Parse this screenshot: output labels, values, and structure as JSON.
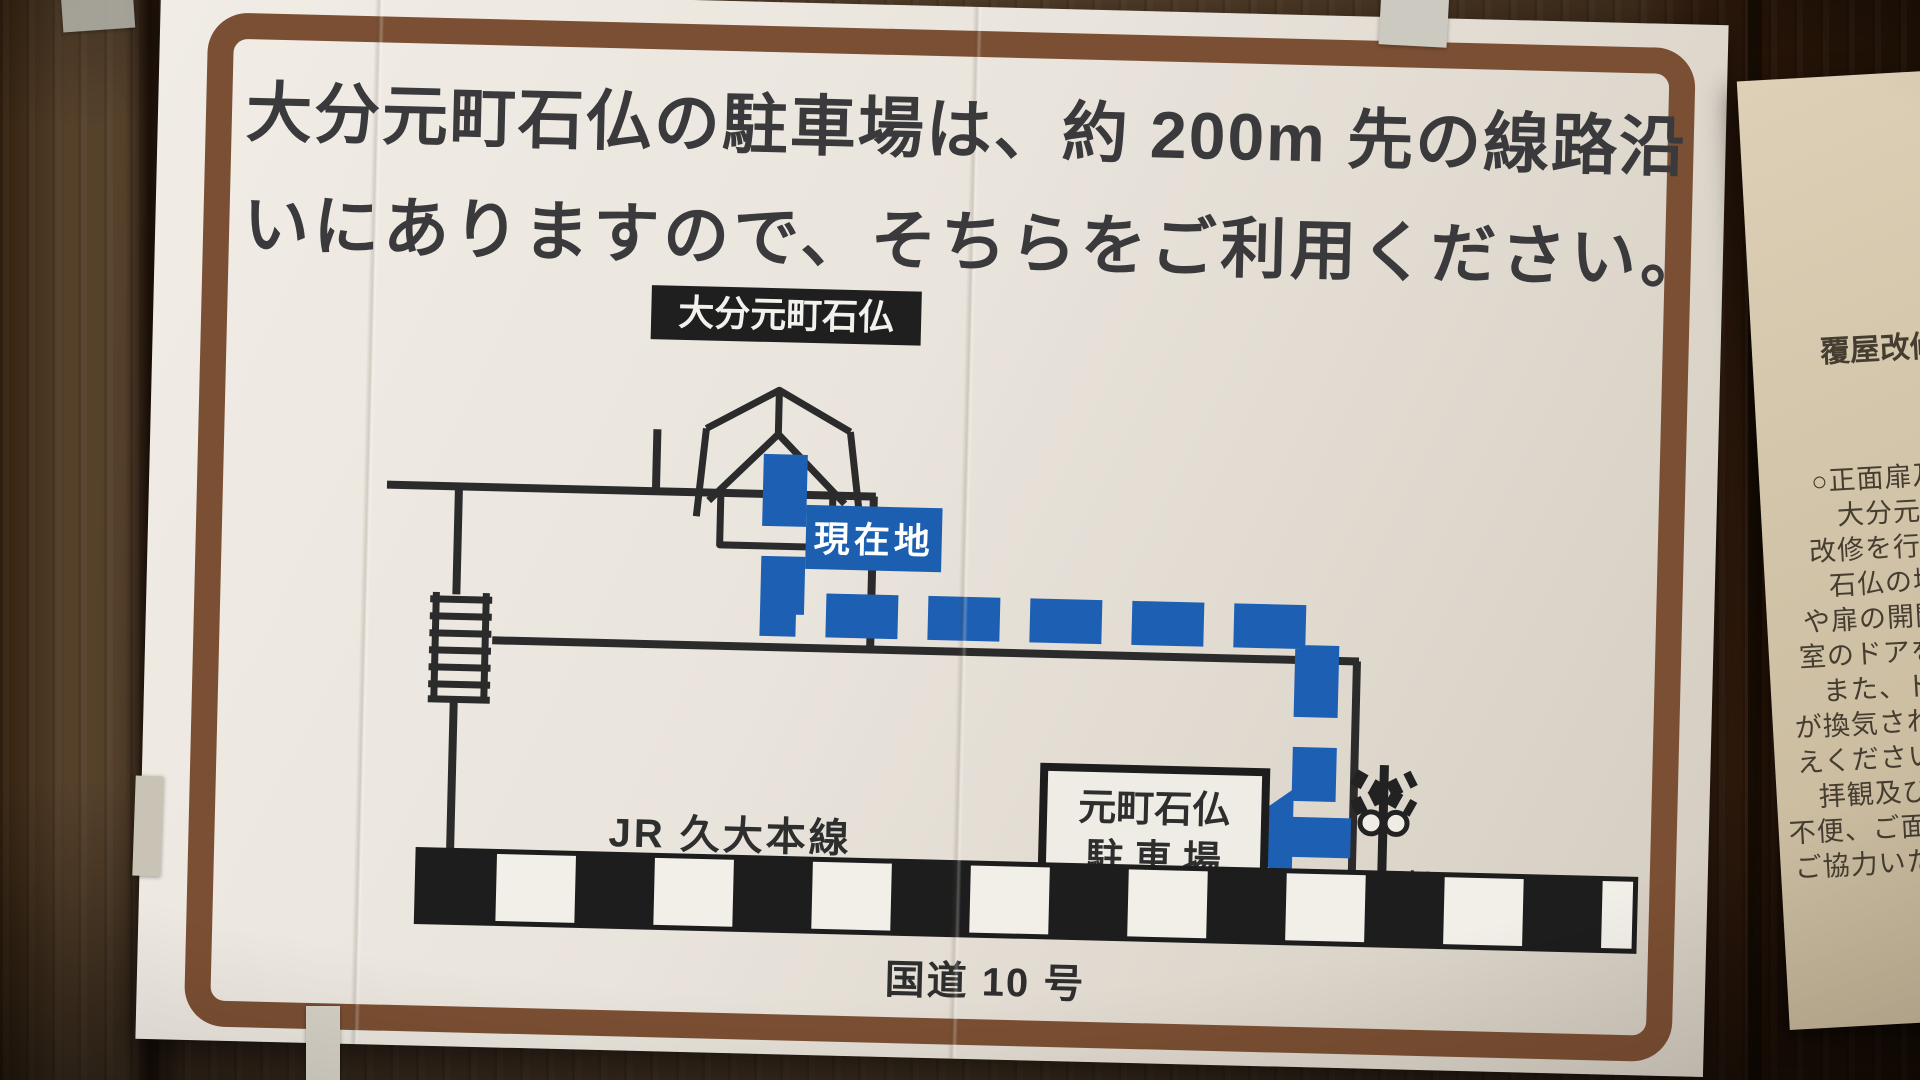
{
  "poster": {
    "heading_line1": "大分元町石仏の駐車場は、約 200m 先の線路沿",
    "heading_line2": "いにありますので、そちらをご利用ください。",
    "map": {
      "site_label": "大分元町石仏",
      "current_location_label": "現在地",
      "parking_label_line1": "元町石仏",
      "parking_label_line2": "駐 車 場",
      "railway_label": "JR 久大本線",
      "crossing_label": "踏切",
      "road_label": "国道 10 号",
      "route_color": "#1d5fb2",
      "current_location_bg": "#1c5fb0",
      "site_label_bg": "#1f1f1f",
      "border_color": "#7b4f33"
    }
  },
  "side_notice": {
    "title": "覆屋改修",
    "lines": [
      "○正面扉及",
      "大分元町石",
      "改修を行いま",
      "石仏の塩類風",
      "や扉の開閉によ",
      "室のドアを自動",
      "また、ドアや",
      "が換気され、石仏",
      "えくださいますよ",
      "拝観及び見学者",
      "不便、ご面倒をお掛",
      "ご協力いただきます"
    ]
  }
}
